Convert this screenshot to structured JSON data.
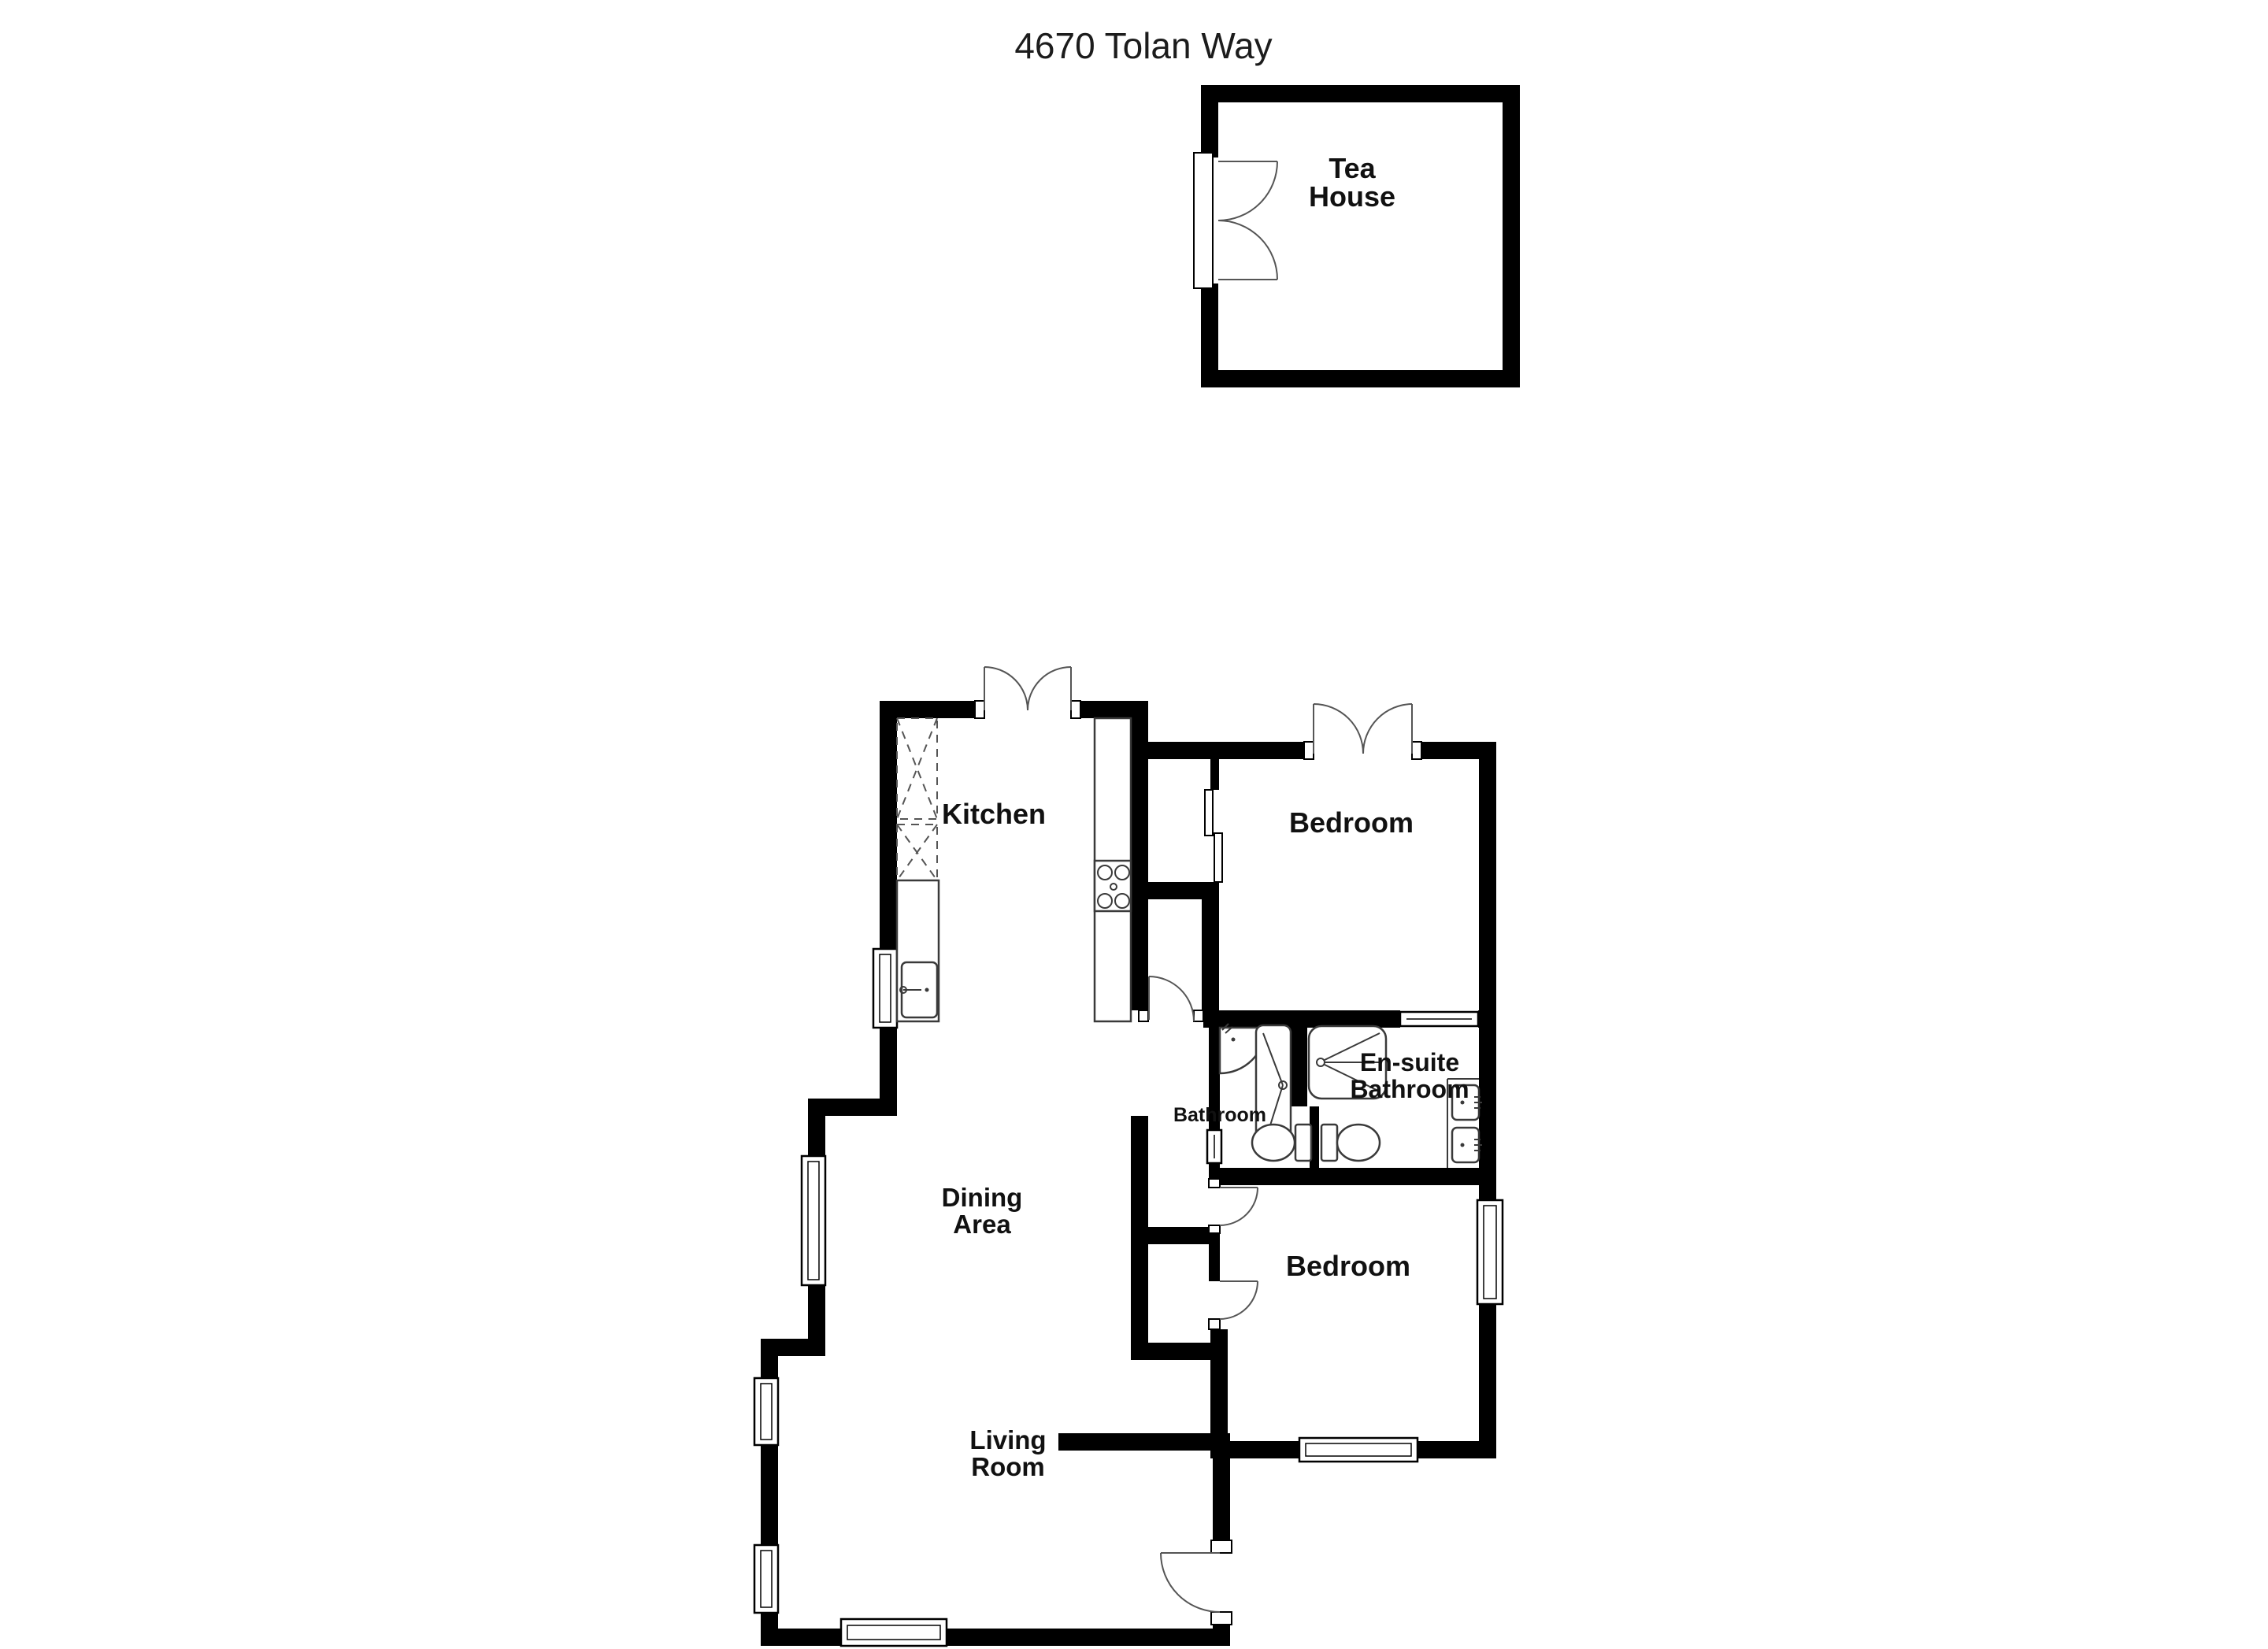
{
  "title": "4670 Tolan Way",
  "colors": {
    "wall": "#000000",
    "background": "#ffffff",
    "fixture_line": "#3a3a3a",
    "label": "#111111"
  },
  "rooms": {
    "tea_house": {
      "line1": "Tea",
      "line2": "House"
    },
    "kitchen": {
      "label": "Kitchen"
    },
    "bedroom_top": {
      "label": "Bedroom"
    },
    "ensuite": {
      "line1": "En-suite",
      "line2": "Bathroom"
    },
    "bathroom": {
      "label": "Bathroom"
    },
    "dining": {
      "line1": "Dining",
      "line2": "Area"
    },
    "bedroom_bottom": {
      "label": "Bedroom"
    },
    "living": {
      "line1": "Living",
      "line2": "Room"
    }
  }
}
